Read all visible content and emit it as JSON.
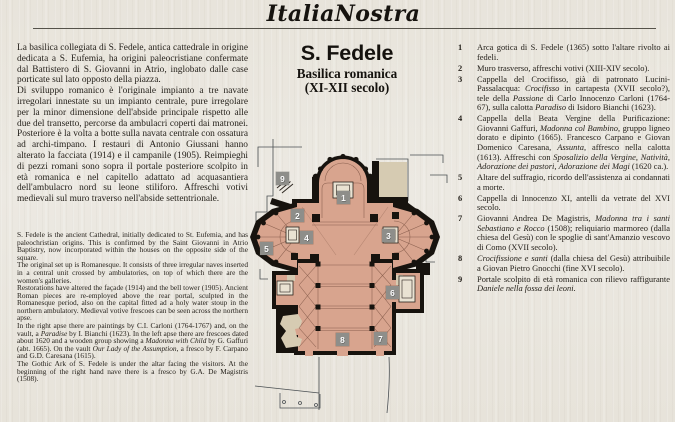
{
  "page": {
    "colors": {
      "paper": "#e9e6df",
      "ink": "#26221c",
      "rule": "#55524a"
    }
  },
  "masthead": {
    "title": "ItaliaNostra"
  },
  "article": {
    "title": "S. Fedele",
    "subtitle_line1": "Basilica romanica",
    "subtitle_line2": "(XI-XII secolo)"
  },
  "left_column": {
    "italian_paragraphs": [
      "La basilica collegiata di S. Fedele, antica cattedrale in origine dedicata a S. Eufemia, ha origini paleocristiane confermate dal Battistero di S. Giovanni in Atrio, inglobato dalle case porticate sul lato opposto della piazza.",
      "Di sviluppo romanico è l'originale impianto a tre navate irregolari innestate su un impianto centrale, pure irregolare per la minor dimensione dell'abside principale rispetto alle due del transetto, percorse da ambulacri coperti dai matronei. Posteriore è la volta a botte sulla navata centrale con ossatura ad archi-timpano. I restauri di Antonio Giussani hanno alterato la facciata (1914) e il campanile (1905). Reimpieghi di pezzi romani sono sopra il portale posteriore scolpito in età romanica e nel capitello adattato ad acquasantiera dell'ambulacro nord su leone stiliforo. Affreschi votivi medievali sul muro traverso nell'abside settentrionale."
    ],
    "english_paragraphs": [
      "S. Fedele is the ancient Cathedral, initially dedicated to St. Eufemia, and has paleochristian origins. This is confirmed by the Saint Giovanni in Atrio Baptistry, now incorporated within the houses on the opposite side of the square.",
      "The original set up is Romanesque. It consists of three irregular naves inserted in a central unit crossed by ambulatories, on top of which there are the women's galleries.",
      "Restorations have altered the façade (1914) and the bell tower (1905). Ancient Roman pieces are re-employed above the rear portal, sculpted in the Romanesque period, also on the capital fitted ad a holy water stoup in the northern ambulatory. Medieval votive frescoes can be seen across the northern apse.",
      "In the right apse there are paintings by C.I. Carloni (1764-1767) and, on the vault, a *Paradise* by I. Bianchi (1623). In the left apse there are frescoes dated about 1620 and a wooden group showing a *Madonna with Child* by G. Gaffuri (abt. 1665). On the vault *Our Lady of the Assumption*, a fresco by F. Carpano and G.D. Caresana (1615).",
      "The Gothic Ark of S. Fedele is under the altar facing the visitors. At the beginning of the right hand nave there is a fresco by G.A. De Magistris (1508)."
    ]
  },
  "legend": {
    "items": [
      {
        "num": "1",
        "text": "Arca gotica di S. Fedele (1365) sotto l'altare rivolto ai fedeli."
      },
      {
        "num": "2",
        "text": "Muro trasverso, affreschi votivi (XIII-XIV secolo)."
      },
      {
        "num": "3",
        "text": "Cappella del Crocifisso, già di patronato Lucini-Passalacqua: *Crocifisso* in cartapesta (XVII secolo?), tele della *Passione* di Carlo Innocenzo Carloni (1764-67), sulla calotta *Paradiso* di Isidoro Bianchi (1623)."
      },
      {
        "num": "4",
        "text": "Cappella della Beata Vergine della Purificazione: Giovanni Gaffuri, *Madonna col Bambino*, gruppo ligneo dorato e dipinto (1665). Francesco Carpano e Giovan Domenico Caresana, *Assunta*, affresco nella calotta (1613). Affreschi con *Sposalizio della Vergine*, *Natività*, *Adorazione dei pastori*, *Adorazione dei Magi* (1620 ca.)."
      },
      {
        "num": "5",
        "text": "Altare del suffragio, ricordo dell'assistenza ai condannati a morte."
      },
      {
        "num": "6",
        "text": "Cappella di Innocenzo XI, antelli da vetrate del XVI secolo."
      },
      {
        "num": "7",
        "text": "Giovanni Andrea De Magistris, *Madonna tra i santi Sebastiano e Rocco* (1508); reliquiario marmoreo (dalla chiesa del Gesù) con le spoglie di sant'Amanzio vescovo di Como (XVII secolo)."
      },
      {
        "num": "8",
        "text": "*Crocifissione e santi* (dalla chiesa del Gesù) attribuibile a Giovan Pietro Gnocchi (fine XVI secolo)."
      },
      {
        "num": "9",
        "text": "Portale scolpito di età romanica con rilievo raffigurante *Daniele nella fossa dei leoni*."
      }
    ]
  },
  "plan": {
    "markers": [
      "1",
      "2",
      "3",
      "4",
      "5",
      "6",
      "7",
      "8",
      "9"
    ],
    "colors": {
      "plan_fill": "#d8a48e",
      "plan_rooms": "#d6cbb2",
      "plan_walls": "#17130e",
      "plan_line": "#8a5f4e",
      "plan_outline": "#4a4f52",
      "marker_bg": "#8e8e8a",
      "altar_fill": "#e9e2d2"
    }
  }
}
